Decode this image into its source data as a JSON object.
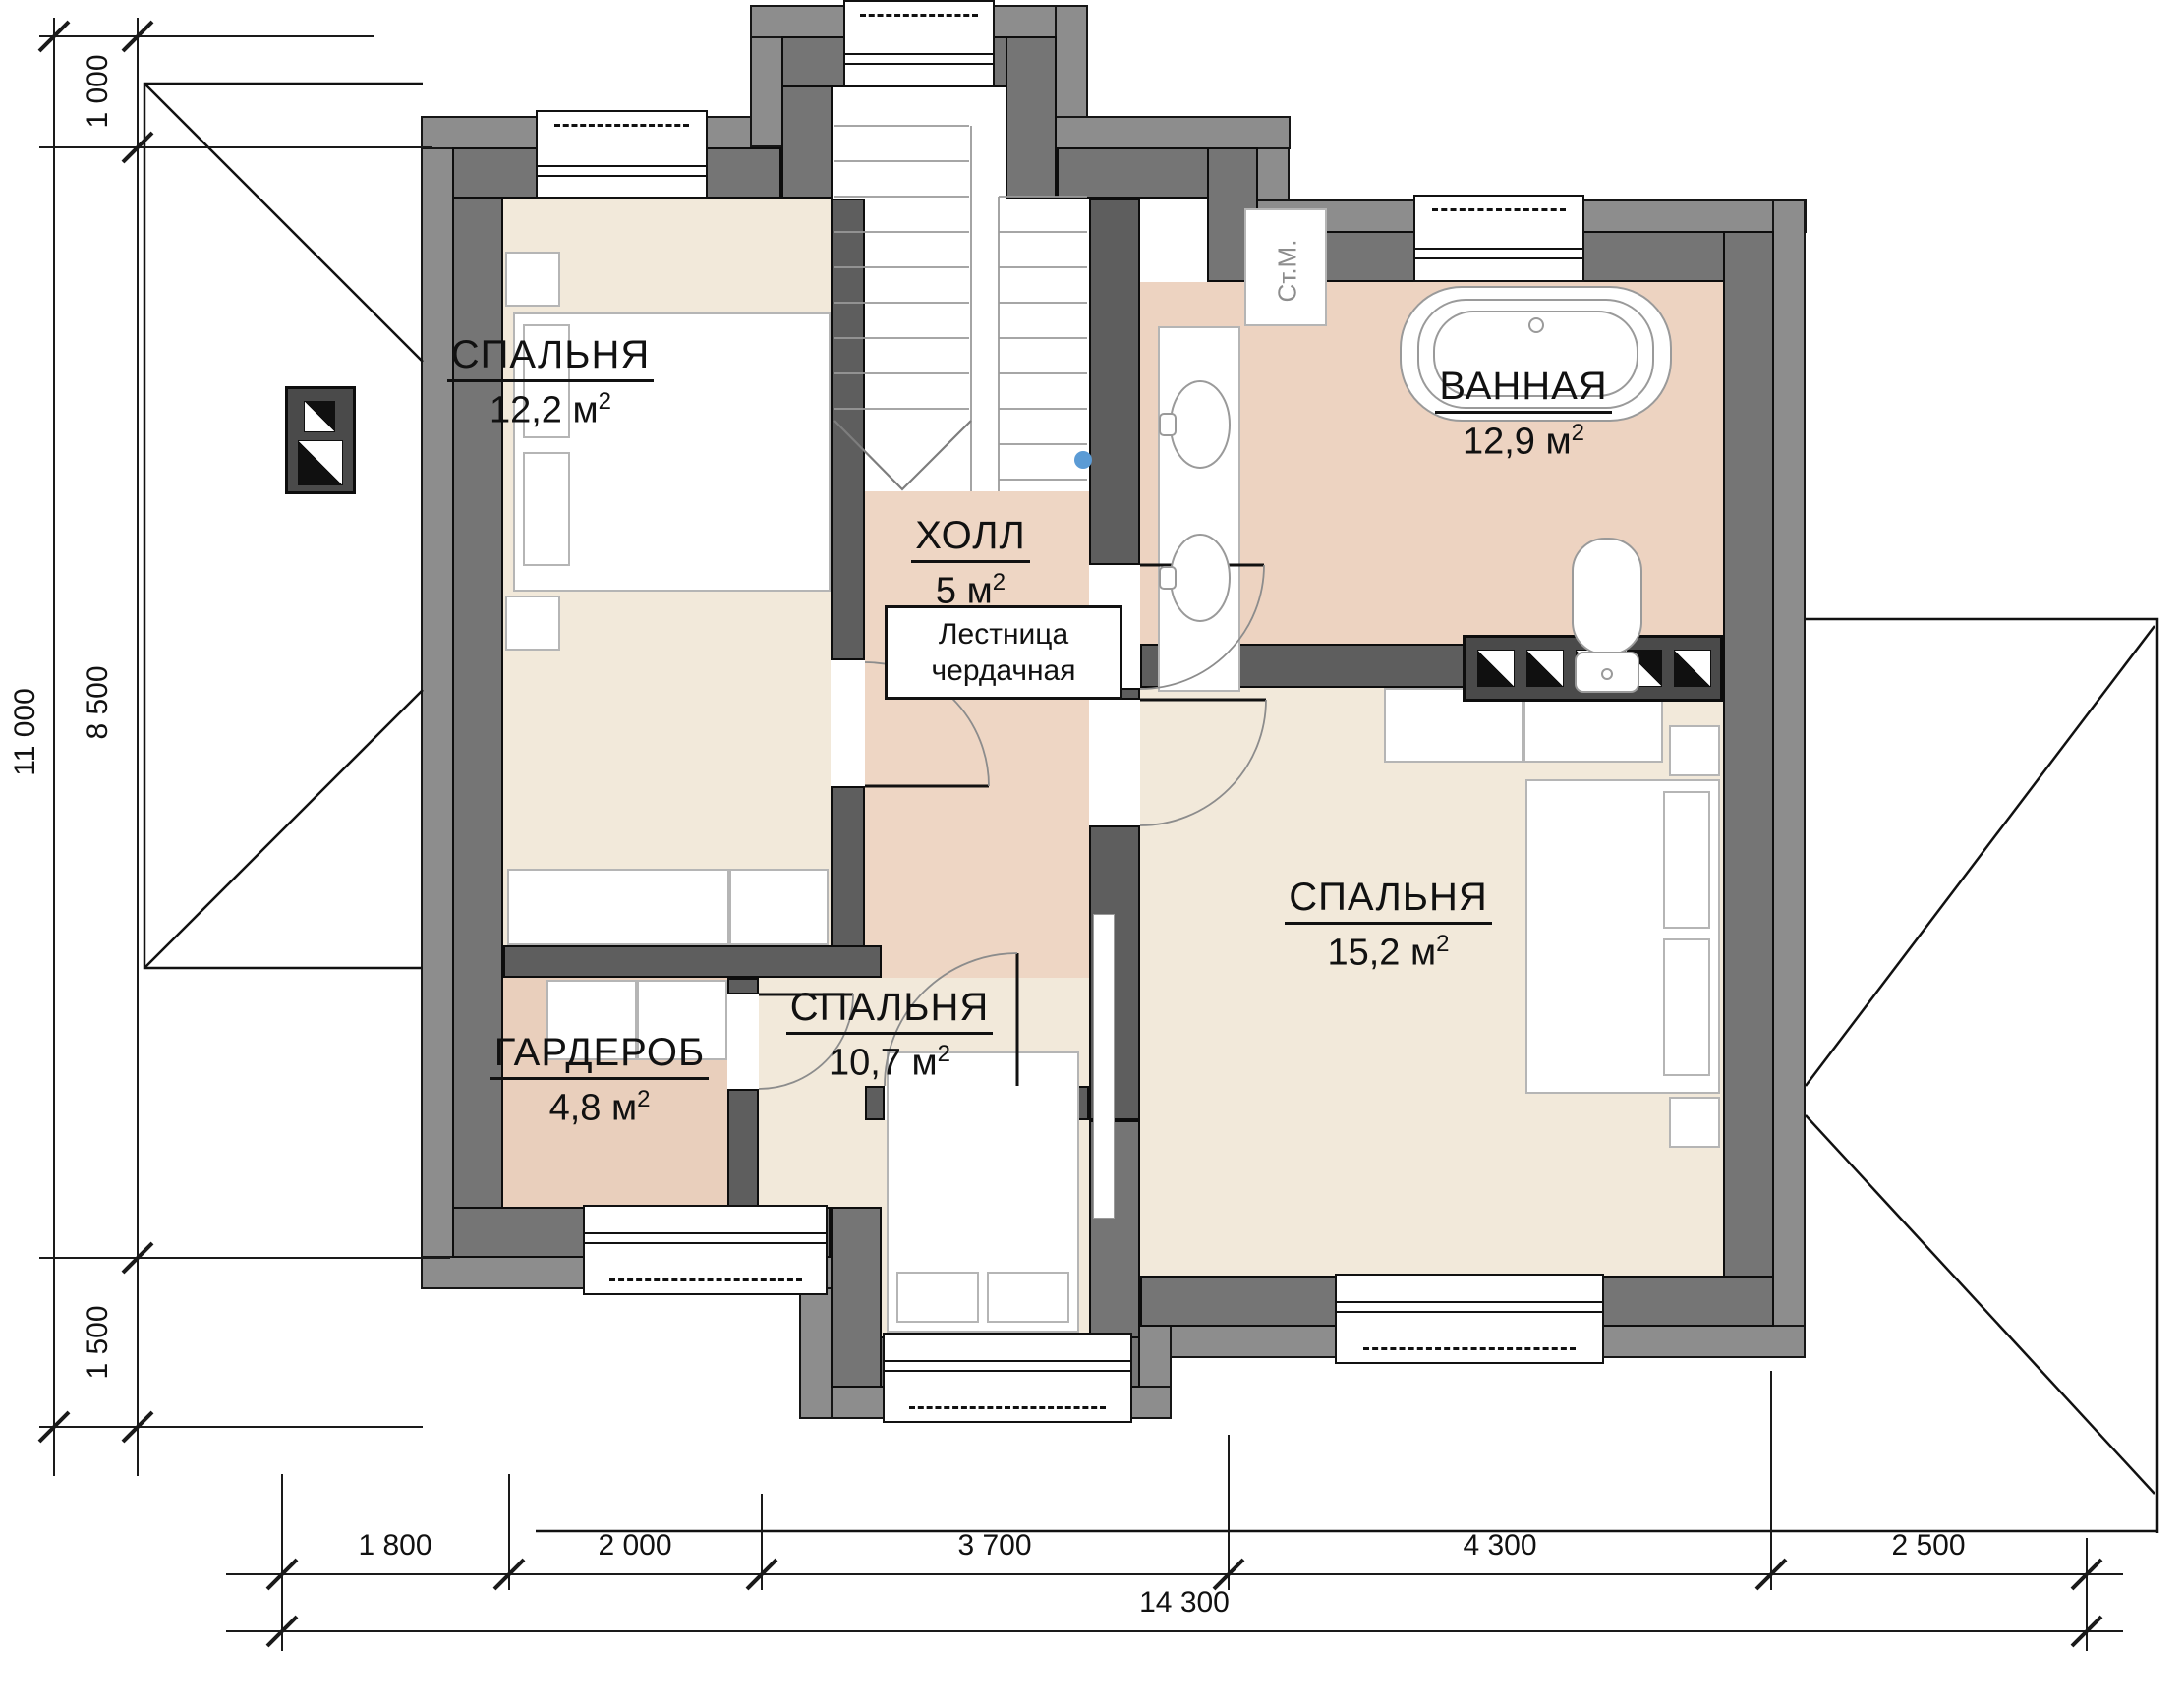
{
  "plan": {
    "title": "floor-plan-attic-level",
    "units": {
      "unit": "м",
      "sq": "2"
    },
    "rooms": [
      {
        "id": "bedroom-12",
        "name": "СПАЛЬНЯ",
        "area": "12,2"
      },
      {
        "id": "hall",
        "name": "ХОЛЛ",
        "area": "5"
      },
      {
        "id": "bathroom",
        "name": "ВАННАЯ",
        "area": "12,9"
      },
      {
        "id": "wardrobe",
        "name": "ГАРДЕРОБ",
        "area": "4,8"
      },
      {
        "id": "bedroom-10",
        "name": "СПАЛЬНЯ",
        "area": "10,7"
      },
      {
        "id": "bedroom-15",
        "name": "СПАЛЬНЯ",
        "area": "15,2"
      }
    ],
    "annotations": {
      "attic_ladder_line1": "Лестница",
      "attic_ladder_line2": "чердачная",
      "washing_machine": "Ст.М."
    },
    "dimensions": {
      "left": {
        "total": "11 000",
        "segments": [
          "1 000",
          "8 500",
          "1 500"
        ]
      },
      "bottom": {
        "total": "14 300",
        "segments": [
          "1 800",
          "2 000",
          "3 700",
          "4 300",
          "2 500"
        ]
      }
    }
  },
  "palette": {
    "wall": "#757575",
    "overhang": "#8d8d8d",
    "partition": "#5e5e5e",
    "floor_bedroom": "#f2e9da",
    "floor_hall": "#eed6c4",
    "floor_bath": "#edd3c1",
    "floor_wardrobe": "#e9cfbc",
    "marker_blue": "#5b9bd5"
  }
}
